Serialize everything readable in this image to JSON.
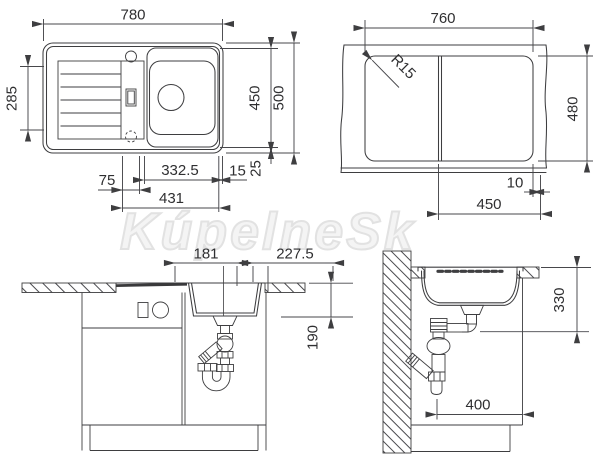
{
  "watermark": {
    "text": "KúpelneSk"
  },
  "views": {
    "plan": {
      "dims": {
        "overall_width": "780",
        "overall_depth": "500",
        "inner_depth": "450",
        "drainer_depth": "285",
        "tap_offset": "75",
        "bowl_width": "332.5",
        "bowl_outer_width": "431",
        "edge_gap": "15",
        "rim_gap": "25"
      }
    },
    "cutout": {
      "dims": {
        "cut_width": "760",
        "cut_depth": "480",
        "corner_radius": "R15",
        "right_span": "450",
        "edge_offset": "10"
      }
    },
    "front": {
      "dims": {
        "left_span": "181",
        "right_span": "227.5",
        "bowl_depth": "190"
      }
    },
    "side": {
      "dims": {
        "drain_height": "330",
        "cabinet_depth": "400"
      }
    }
  },
  "colors": {
    "line": "#3e3e40",
    "text": "#2f2f31",
    "watermark": "#e2e2e2"
  }
}
